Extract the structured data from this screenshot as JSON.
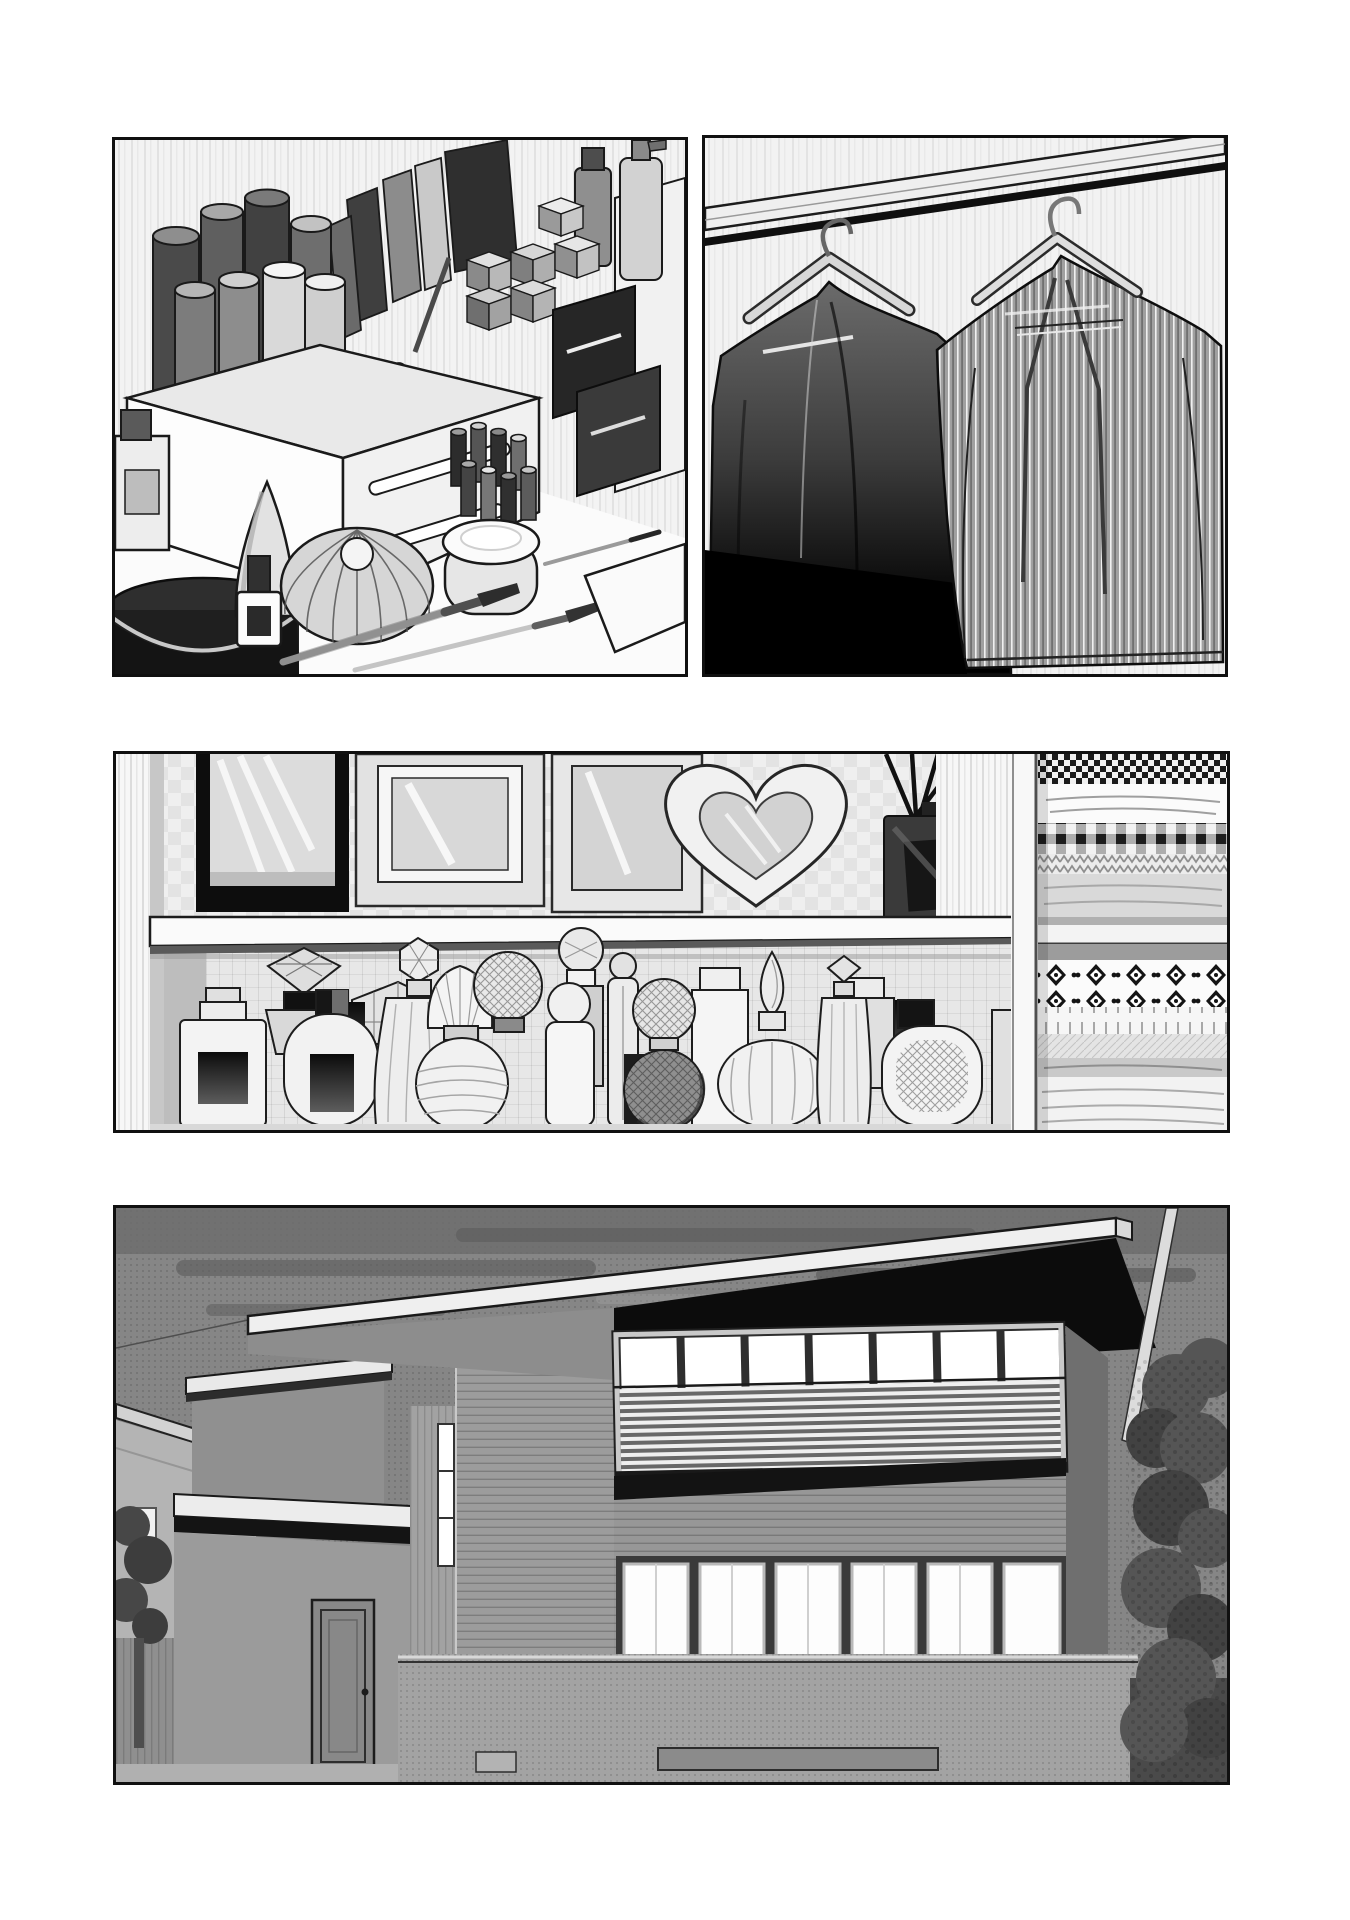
{
  "page": {
    "kind": "manga-page",
    "panel_count": 4,
    "background_color": "#ffffff",
    "ink_color": "#101010"
  },
  "palette": {
    "paper": "#ffffff",
    "ink": "#101010",
    "tone_light": "#ececec",
    "tone_mid": "#9a9a9a",
    "tone_dark": "#4c4c4c",
    "solid_black": "#0b0b0b",
    "sky": "#868686"
  },
  "panels": [
    {
      "id": "panel-1",
      "name": "cosmetics-organizer",
      "description": "Isometric white organizer box crowded with tall cosmetic bottles, tubes and jars; stacked square palettes and dark boxes behind; ribbed pincushion case, cream jar, cone bottle, nail polish and long makeup brushes in front of a striped wall."
    },
    {
      "id": "panel-2",
      "name": "hanging-coats",
      "description": "Two overcoats on wooden hangers hung from a light wooden closet rail: a dark coat fading into black shadow and a larger grey pinstriped overcoat."
    },
    {
      "id": "panel-3",
      "name": "vanity-shelf-and-linen-closet",
      "description": "White shelf holding a black-framed mirror, two picture frames, a heart-shaped frame and a reed diffuser; ornate glass perfume bottles lined up below; folded patterned blankets stacked in the closet bay on the right."
    },
    {
      "id": "panel-4",
      "name": "house-exterior-at-dusk",
      "description": "Modern flat-roofed two-storey house under a dark evening sky; lit clerestory windows behind a slatted balcony rail, glowing ground-floor windows, entrance door, carport slab, neighbouring roof and trees."
    }
  ]
}
